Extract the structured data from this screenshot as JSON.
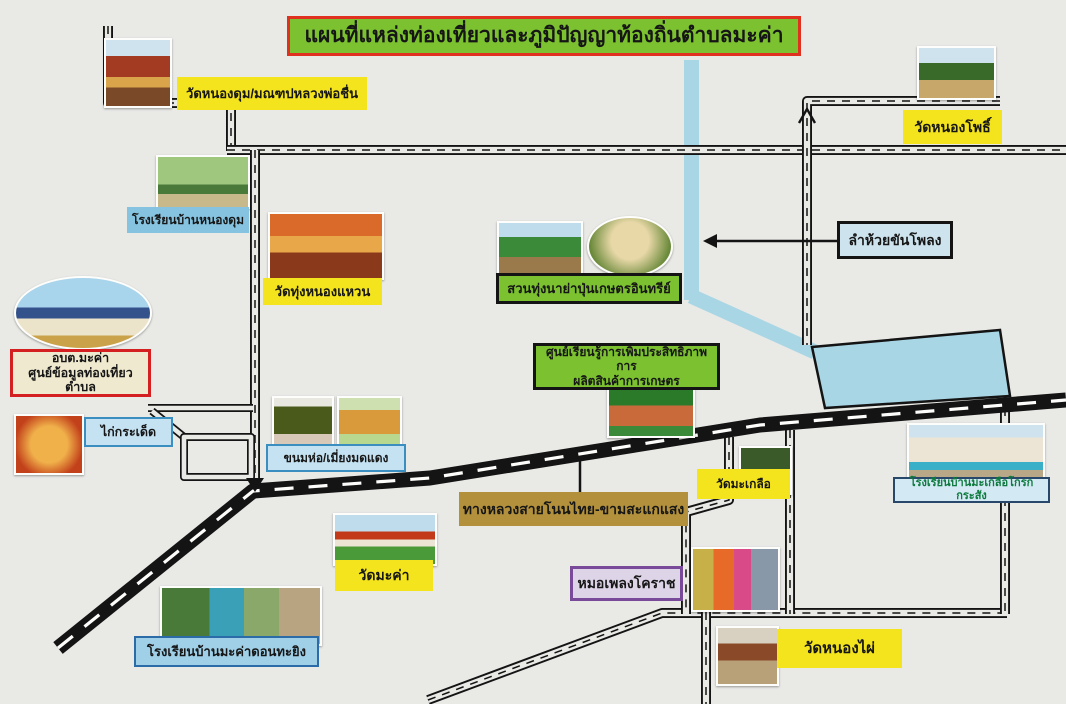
{
  "title": "แผนที่แหล่งท่องเที่ยวและภูมิปัญญาท้องถิ่นตำบลมะค่า",
  "labels": {
    "wat_nong_dum": "วัดหนองดุม/มณฑปหลวงพ่อชื่น",
    "school_nong_dum": "โรงเรียนบ้านหนองดุม",
    "wat_thung_nong_waen": "วัดทุ่งหนองแหวน",
    "suan_thung": "สวนทุ่งนาย่าปุ่นเกษตรอินทรีย์",
    "lam_huai": "ลำห้วยขันโพลง",
    "obt_line1": "อบต.มะค่า",
    "obt_line2": "ศูนย์ข้อมูลท่องเที่ยวตำบล",
    "kai_kradet": "ไก่กระเด็ด",
    "khanom_ho": "ขนมห่อ/เมี่ยงมดแดง",
    "learning_line1": "ศูนย์เรียนรู้การเพิ่มประสิทธิภาพการ",
    "learning_line2": "ผลิตสินค้าการเกษตร",
    "wat_makluea": "วัดมะเกลือ",
    "school_makluea": "โรงเรียนบ้านมะเกลือโกรกกระสัง",
    "highway": "ทางหลวงสายโนนไทย-ขามสะแกแสง",
    "wat_makha": "วัดมะค่า",
    "school_makha_don": "โรงเรียนบ้านมะค่าดอนทะยิง",
    "mo_phleng": "หมอเพลงโคราช",
    "wat_nong_phai": "วัดหนองไผ่",
    "wat_nong_pho": "วัดหนองโพธิ์"
  },
  "colors": {
    "background": "#e9e9e6",
    "title_fill": "#7cc230",
    "title_border": "#e03020",
    "yellow_label": "#f4e41d",
    "blue_label": "#c4e2f2",
    "green_label": "#7cc230",
    "stream": "#a9d6e5",
    "highway_label": "#b3913c",
    "lavender_label": "#ded4e8",
    "purple_border": "#7a4a9a",
    "obt_fill": "#efeacf",
    "obt_border": "#d42020",
    "road": "#141414"
  }
}
